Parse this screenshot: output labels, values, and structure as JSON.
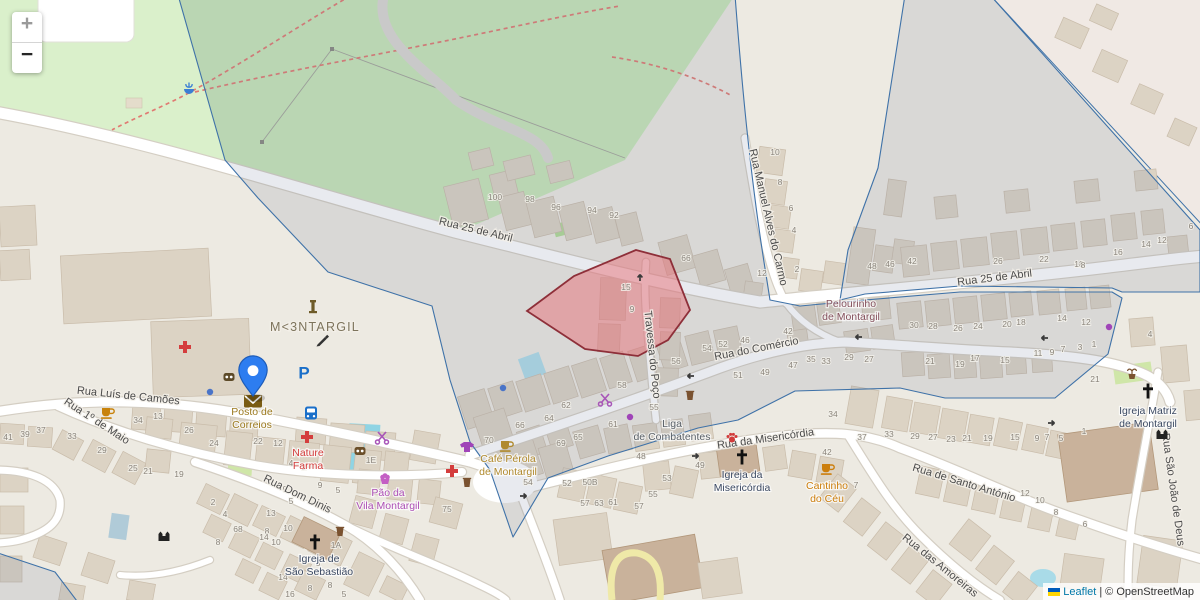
{
  "controls": {
    "zoom_in": "+",
    "zoom_out": "−"
  },
  "attribution": {
    "leaflet": "Leaflet",
    "separator": " | ",
    "osm": "© OpenStreetMap"
  },
  "marker": {
    "title": "Posto de Correios"
  },
  "colors": {
    "land": "#edeae2",
    "park": "#c9e8b8",
    "park_light": "#daf0cb",
    "road": "#ffffff",
    "overlay_stroke": "#3f72a8",
    "overlay_fill": "rgba(110,125,155,0.16)",
    "highlight_fill": "rgba(231,112,120,0.5)",
    "highlight_stroke": "#8e2f39",
    "water": "#8fd4e4",
    "marker_blue": "#2d7df0",
    "link_blue": "#0078a8"
  },
  "streets": [
    {
      "t": "Rua 25 de Abril",
      "x": 475,
      "y": 233,
      "r": 13.5
    },
    {
      "t": "Rua 25 de Abril",
      "x": 995,
      "y": 281,
      "r": -7
    },
    {
      "t": "Rua do Comércio",
      "x": 757,
      "y": 352,
      "r": -11
    },
    {
      "t": "Travessa do Poço",
      "x": 649,
      "y": 355,
      "r": 84
    },
    {
      "t": "Rua Manuel Alves do Carmo",
      "x": 765,
      "y": 218,
      "r": 77
    },
    {
      "t": "Rua Luís de Camões",
      "x": 128,
      "y": 399,
      "r": 6
    },
    {
      "t": "Rua 1º de Maio",
      "x": 95,
      "y": 424,
      "r": 33
    },
    {
      "t": "Rua Dom Dinis",
      "x": 296,
      "y": 497,
      "r": 26
    },
    {
      "t": "Rua da Misericórdia",
      "x": 766,
      "y": 442,
      "r": -8
    },
    {
      "t": "Rua de Santo António",
      "x": 963,
      "y": 486,
      "r": 17
    },
    {
      "t": "Rua das Amoreiras",
      "x": 938,
      "y": 568,
      "r": 39
    },
    {
      "t": "Rua São João de Deus",
      "x": 1170,
      "y": 490,
      "r": 82
    }
  ],
  "places": [
    {
      "t": "M<3NTARGIL",
      "x": 315,
      "y": 331,
      "color": "#7d745c"
    }
  ],
  "pois": [
    {
      "lines": [
        "Posto de",
        "Correios"
      ],
      "x": 252,
      "y": 415,
      "color": "#9c7a1f"
    },
    {
      "lines": [
        "Nature",
        "Farma"
      ],
      "x": 308,
      "y": 456,
      "color": "#d43d3d"
    },
    {
      "lines": [
        "Pão da",
        "Vila Montargil"
      ],
      "x": 388,
      "y": 496,
      "color": "#ac4fb5"
    },
    {
      "lines": [
        "Café Pérola",
        "de Montargil"
      ],
      "x": 508,
      "y": 462,
      "color": "#b08a2e"
    },
    {
      "lines": [
        "Cantinho",
        "do Céu"
      ],
      "x": 827,
      "y": 489,
      "color": "#cc7e0c"
    },
    {
      "lines": [
        "Liga",
        "de Combatentes"
      ],
      "x": 672,
      "y": 427,
      "color": "#5a6168"
    },
    {
      "lines": [
        "Pelourinho",
        "de Montargil"
      ],
      "x": 851,
      "y": 307,
      "color": "#84505c"
    },
    {
      "lines": [
        "Igreja da",
        "Misericórdia"
      ],
      "x": 742,
      "y": 478,
      "color": "#3c4a63"
    },
    {
      "lines": [
        "Igreja de",
        "São Sebastião"
      ],
      "x": 319,
      "y": 562,
      "color": "#3c4a63"
    },
    {
      "lines": [
        "Igreja Matriz",
        "de Montargil"
      ],
      "x": 1148,
      "y": 414,
      "color": "#3c4a63"
    }
  ],
  "house_numbers": [
    {
      "t": "100",
      "x": 495,
      "y": 200
    },
    {
      "t": "98",
      "x": 530,
      "y": 202
    },
    {
      "t": "96",
      "x": 556,
      "y": 210
    },
    {
      "t": "94",
      "x": 592,
      "y": 213
    },
    {
      "t": "92",
      "x": 614,
      "y": 218
    },
    {
      "t": "66",
      "x": 686,
      "y": 261
    },
    {
      "t": "15",
      "x": 626,
      "y": 290
    },
    {
      "t": "9",
      "x": 632,
      "y": 312
    },
    {
      "t": "54",
      "x": 707,
      "y": 351
    },
    {
      "t": "56",
      "x": 676,
      "y": 364
    },
    {
      "t": "42",
      "x": 788,
      "y": 334
    },
    {
      "t": "46",
      "x": 745,
      "y": 343
    },
    {
      "t": "52",
      "x": 723,
      "y": 347
    },
    {
      "t": "47",
      "x": 793,
      "y": 368
    },
    {
      "t": "35",
      "x": 811,
      "y": 362
    },
    {
      "t": "33",
      "x": 826,
      "y": 364
    },
    {
      "t": "29",
      "x": 849,
      "y": 360
    },
    {
      "t": "27",
      "x": 869,
      "y": 362
    },
    {
      "t": "49",
      "x": 765,
      "y": 375
    },
    {
      "t": "51",
      "x": 738,
      "y": 378
    },
    {
      "t": "55",
      "x": 654,
      "y": 410
    },
    {
      "t": "61",
      "x": 613,
      "y": 427
    },
    {
      "t": "62",
      "x": 566,
      "y": 408
    },
    {
      "t": "64",
      "x": 549,
      "y": 421
    },
    {
      "t": "66",
      "x": 520,
      "y": 428
    },
    {
      "t": "70",
      "x": 489,
      "y": 443
    },
    {
      "t": "65",
      "x": 578,
      "y": 440
    },
    {
      "t": "69",
      "x": 561,
      "y": 446
    },
    {
      "t": "58",
      "x": 622,
      "y": 388
    },
    {
      "t": "48",
      "x": 641,
      "y": 459
    },
    {
      "t": "49",
      "x": 700,
      "y": 468
    },
    {
      "t": "53",
      "x": 667,
      "y": 481
    },
    {
      "t": "55",
      "x": 653,
      "y": 497
    },
    {
      "t": "57",
      "x": 585,
      "y": 506
    },
    {
      "t": "63",
      "x": 599,
      "y": 506
    },
    {
      "t": "61",
      "x": 613,
      "y": 505
    },
    {
      "t": "57",
      "x": 639,
      "y": 509
    },
    {
      "t": "50B",
      "x": 590,
      "y": 485
    },
    {
      "t": "52",
      "x": 567,
      "y": 486
    },
    {
      "t": "54",
      "x": 528,
      "y": 485
    },
    {
      "t": "34",
      "x": 833,
      "y": 417
    },
    {
      "t": "37",
      "x": 862,
      "y": 440
    },
    {
      "t": "33",
      "x": 889,
      "y": 437
    },
    {
      "t": "42",
      "x": 827,
      "y": 455
    },
    {
      "t": "29",
      "x": 915,
      "y": 439
    },
    {
      "t": "27",
      "x": 933,
      "y": 440
    },
    {
      "t": "23",
      "x": 951,
      "y": 442
    },
    {
      "t": "21",
      "x": 967,
      "y": 441
    },
    {
      "t": "19",
      "x": 988,
      "y": 441
    },
    {
      "t": "15",
      "x": 1015,
      "y": 440
    },
    {
      "t": "9",
      "x": 1037,
      "y": 441
    },
    {
      "t": "7",
      "x": 1047,
      "y": 440
    },
    {
      "t": "5",
      "x": 1061,
      "y": 441
    },
    {
      "t": "1",
      "x": 1084,
      "y": 434
    },
    {
      "t": "7",
      "x": 856,
      "y": 488
    },
    {
      "t": "12",
      "x": 1025,
      "y": 496
    },
    {
      "t": "10",
      "x": 1040,
      "y": 503
    },
    {
      "t": "8",
      "x": 1056,
      "y": 515
    },
    {
      "t": "6",
      "x": 1085,
      "y": 527
    },
    {
      "t": "42",
      "x": 912,
      "y": 264
    },
    {
      "t": "26",
      "x": 998,
      "y": 264
    },
    {
      "t": "22",
      "x": 1044,
      "y": 262
    },
    {
      "t": "18",
      "x": 1079,
      "y": 267
    },
    {
      "t": "16",
      "x": 1118,
      "y": 255
    },
    {
      "t": "14",
      "x": 1146,
      "y": 247
    },
    {
      "t": "12",
      "x": 1162,
      "y": 243
    },
    {
      "t": "6",
      "x": 1191,
      "y": 229
    },
    {
      "t": "8",
      "x": 1083,
      "y": 268
    },
    {
      "t": "30",
      "x": 914,
      "y": 328
    },
    {
      "t": "28",
      "x": 933,
      "y": 329
    },
    {
      "t": "26",
      "x": 958,
      "y": 331
    },
    {
      "t": "24",
      "x": 978,
      "y": 329
    },
    {
      "t": "20",
      "x": 1007,
      "y": 327
    },
    {
      "t": "18",
      "x": 1021,
      "y": 325
    },
    {
      "t": "14",
      "x": 1062,
      "y": 321
    },
    {
      "t": "12",
      "x": 1086,
      "y": 325
    },
    {
      "t": "4",
      "x": 1150,
      "y": 337
    },
    {
      "t": "21",
      "x": 930,
      "y": 364
    },
    {
      "t": "19",
      "x": 960,
      "y": 367
    },
    {
      "t": "17",
      "x": 975,
      "y": 361
    },
    {
      "t": "15",
      "x": 1005,
      "y": 363
    },
    {
      "t": "11",
      "x": 1038,
      "y": 356
    },
    {
      "t": "9",
      "x": 1052,
      "y": 355
    },
    {
      "t": "7",
      "x": 1063,
      "y": 352
    },
    {
      "t": "3",
      "x": 1080,
      "y": 350
    },
    {
      "t": "1",
      "x": 1094,
      "y": 347
    },
    {
      "t": "21",
      "x": 1095,
      "y": 382
    },
    {
      "t": "10",
      "x": 775,
      "y": 155
    },
    {
      "t": "8",
      "x": 780,
      "y": 185
    },
    {
      "t": "6",
      "x": 791,
      "y": 211
    },
    {
      "t": "4",
      "x": 794,
      "y": 233
    },
    {
      "t": "2",
      "x": 797,
      "y": 272
    },
    {
      "t": "12",
      "x": 762,
      "y": 276
    },
    {
      "t": "48",
      "x": 872,
      "y": 269
    },
    {
      "t": "46",
      "x": 890,
      "y": 267
    },
    {
      "t": "41",
      "x": 8,
      "y": 440
    },
    {
      "t": "39",
      "x": 25,
      "y": 437
    },
    {
      "t": "37",
      "x": 41,
      "y": 433
    },
    {
      "t": "33",
      "x": 72,
      "y": 439
    },
    {
      "t": "29",
      "x": 102,
      "y": 453
    },
    {
      "t": "34",
      "x": 138,
      "y": 423
    },
    {
      "t": "13",
      "x": 158,
      "y": 419
    },
    {
      "t": "26",
      "x": 189,
      "y": 433
    },
    {
      "t": "24",
      "x": 214,
      "y": 446
    },
    {
      "t": "25",
      "x": 133,
      "y": 471
    },
    {
      "t": "21",
      "x": 148,
      "y": 474
    },
    {
      "t": "19",
      "x": 179,
      "y": 477
    },
    {
      "t": "22",
      "x": 258,
      "y": 444
    },
    {
      "t": "12",
      "x": 278,
      "y": 446
    },
    {
      "t": "4",
      "x": 291,
      "y": 466
    },
    {
      "t": "2",
      "x": 304,
      "y": 470
    },
    {
      "t": "1E",
      "x": 371,
      "y": 463
    },
    {
      "t": "9",
      "x": 285,
      "y": 492
    },
    {
      "t": "5",
      "x": 291,
      "y": 504
    },
    {
      "t": "13",
      "x": 271,
      "y": 516
    },
    {
      "t": "10",
      "x": 288,
      "y": 531
    },
    {
      "t": "8",
      "x": 267,
      "y": 534
    },
    {
      "t": "10",
      "x": 276,
      "y": 545
    },
    {
      "t": "2",
      "x": 213,
      "y": 505
    },
    {
      "t": "4",
      "x": 225,
      "y": 517
    },
    {
      "t": "68",
      "x": 238,
      "y": 532
    },
    {
      "t": "8",
      "x": 218,
      "y": 545
    },
    {
      "t": "14",
      "x": 264,
      "y": 540
    },
    {
      "t": "1A",
      "x": 336,
      "y": 548
    },
    {
      "t": "3",
      "x": 318,
      "y": 566
    },
    {
      "t": "8",
      "x": 310,
      "y": 591
    },
    {
      "t": "5",
      "x": 344,
      "y": 597
    },
    {
      "t": "75",
      "x": 447,
      "y": 512
    },
    {
      "t": "9",
      "x": 320,
      "y": 488
    },
    {
      "t": "5",
      "x": 338,
      "y": 493
    },
    {
      "t": "14",
      "x": 283,
      "y": 580
    },
    {
      "t": "16",
      "x": 290,
      "y": 597
    },
    {
      "t": "8",
      "x": 330,
      "y": 588
    }
  ],
  "icons": [
    {
      "name": "post-office-envelope-icon",
      "shape": "envelope",
      "x": 253,
      "y": 401,
      "color": "#7a5c13"
    },
    {
      "name": "parking-icon",
      "shape": "parking",
      "x": 304,
      "y": 373,
      "color": "#1a6fc9"
    },
    {
      "name": "bus-stop-icon",
      "shape": "bus",
      "x": 311,
      "y": 413,
      "color": "#1a6fc9"
    },
    {
      "name": "pharmacy-cross-icon",
      "shape": "cross",
      "x": 307,
      "y": 437,
      "color": "#d43d3d"
    },
    {
      "name": "clinic-cross-icon",
      "shape": "cross",
      "x": 185,
      "y": 347,
      "color": "#d43d3d"
    },
    {
      "name": "clinic-cross-icon",
      "shape": "cross",
      "x": 452,
      "y": 471,
      "color": "#d43d3d"
    },
    {
      "name": "cafe-icon",
      "shape": "cup",
      "x": 107,
      "y": 412,
      "color": "#c8820a"
    },
    {
      "name": "cafe-icon",
      "shape": "cup",
      "x": 506,
      "y": 445,
      "color": "#b08a2e"
    },
    {
      "name": "cafe-icon",
      "shape": "cup",
      "x": 827,
      "y": 468,
      "color": "#cc7e0c"
    },
    {
      "name": "veterinary-paw-icon",
      "shape": "paw",
      "x": 732,
      "y": 438,
      "color": "#d23b3b"
    },
    {
      "name": "hairdresser-scissors-icon",
      "shape": "scissors",
      "x": 382,
      "y": 437,
      "color": "#a855b8"
    },
    {
      "name": "hairdresser-scissors-icon",
      "shape": "scissors",
      "x": 605,
      "y": 399,
      "color": "#a855b8"
    },
    {
      "name": "clothes-shop-icon",
      "shape": "tshirt",
      "x": 467,
      "y": 447,
      "color": "#a044b8"
    },
    {
      "name": "bakery-cupcake-icon",
      "shape": "cupcake",
      "x": 385,
      "y": 479,
      "color": "#c45fc4"
    },
    {
      "name": "optician-icon",
      "shape": "glasses",
      "x": 360,
      "y": 451,
      "color": "#6b4f2a"
    },
    {
      "name": "shop-icon",
      "shape": "glasses",
      "x": 229,
      "y": 377,
      "color": "#5d4a28"
    },
    {
      "name": "monument-icon",
      "shape": "monument",
      "x": 313,
      "y": 310,
      "color": "#6e5b28"
    },
    {
      "name": "artwork-brush-icon",
      "shape": "brush",
      "x": 322,
      "y": 340,
      "color": "#333333"
    },
    {
      "name": "fountain-icon",
      "shape": "fountain",
      "x": 189,
      "y": 89,
      "color": "#3b7fd4"
    },
    {
      "name": "plant-pot-icon",
      "shape": "pot",
      "x": 1132,
      "y": 374,
      "color": "#7a5230"
    },
    {
      "name": "city-gate-icon",
      "shape": "gate",
      "x": 1162,
      "y": 434,
      "color": "#222222"
    },
    {
      "name": "city-gate-icon",
      "shape": "gate",
      "x": 164,
      "y": 536,
      "color": "#222222"
    },
    {
      "name": "church-cross-icon",
      "shape": "church",
      "x": 742,
      "y": 457,
      "color": "#111111"
    },
    {
      "name": "church-cross-icon",
      "shape": "church",
      "x": 315,
      "y": 542,
      "color": "#111111"
    },
    {
      "name": "church-cross-icon",
      "shape": "church",
      "x": 1148,
      "y": 391,
      "color": "#111111"
    },
    {
      "name": "waste-basket-icon",
      "shape": "basket",
      "x": 340,
      "y": 532,
      "color": "#7a5230"
    },
    {
      "name": "waste-basket-icon",
      "shape": "basket",
      "x": 467,
      "y": 483,
      "color": "#7a5230"
    },
    {
      "name": "waste-basket-icon",
      "shape": "basket",
      "x": 690,
      "y": 396,
      "color": "#7a5230"
    },
    {
      "name": "poi-dot-icon",
      "shape": "dot",
      "x": 210,
      "y": 392,
      "color": "#4a74c8"
    },
    {
      "name": "poi-dot-icon",
      "shape": "dot",
      "x": 503,
      "y": 388,
      "color": "#4a74c8"
    },
    {
      "name": "poi-dot-icon",
      "shape": "dot",
      "x": 630,
      "y": 417,
      "color": "#a044b8"
    },
    {
      "name": "poi-dot-icon",
      "shape": "dot",
      "x": 1109,
      "y": 327,
      "color": "#a044b8"
    },
    {
      "name": "oneway-arrow-icon",
      "shape": "arrowL",
      "x": 690,
      "y": 376,
      "color": "#3a3a3a"
    },
    {
      "name": "oneway-arrow-icon",
      "shape": "arrowL",
      "x": 858,
      "y": 337,
      "color": "#3a3a3a"
    },
    {
      "name": "oneway-arrow-icon",
      "shape": "arrowL",
      "x": 1044,
      "y": 338,
      "color": "#3a3a3a"
    },
    {
      "name": "oneway-arrow-icon",
      "shape": "arrowR",
      "x": 524,
      "y": 496,
      "color": "#3a3a3a"
    },
    {
      "name": "oneway-arrow-icon",
      "shape": "arrowR",
      "x": 696,
      "y": 456,
      "color": "#3a3a3a"
    },
    {
      "name": "oneway-arrow-icon",
      "shape": "arrowR",
      "x": 1052,
      "y": 423,
      "color": "#3a3a3a"
    },
    {
      "name": "oneway-arrow-icon",
      "shape": "arrowU",
      "x": 640,
      "y": 277,
      "color": "#3a3a3a"
    }
  ]
}
